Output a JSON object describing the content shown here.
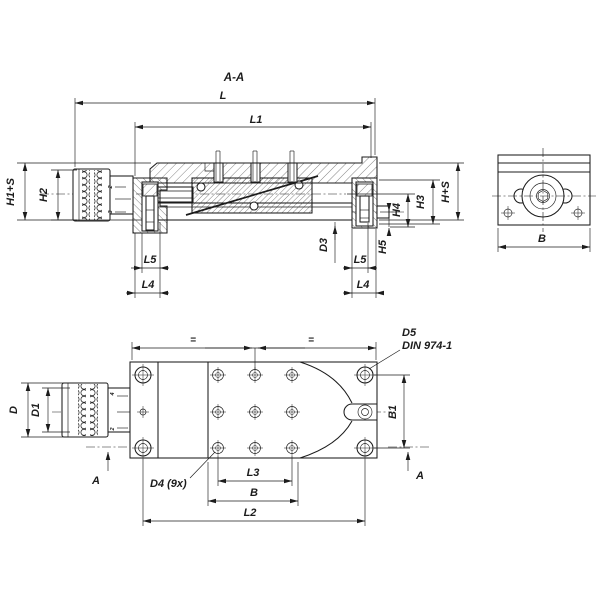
{
  "colors": {
    "ink": "#1c1c1c",
    "background": "#ffffff"
  },
  "title": {
    "section": "A-A"
  },
  "section": {
    "dims": {
      "L": "L",
      "L1": "L1",
      "H1S": "H1+S",
      "H2": "H2",
      "L5_left": "L5",
      "L4_left": "L4",
      "D3": "D3",
      "L5_right": "L5",
      "L4_right": "L4",
      "H5": "H5",
      "H4": "H4",
      "H3": "H3",
      "HS": "H+S"
    },
    "dial": {
      "top": "2",
      "bottom": "3"
    }
  },
  "side": {
    "dims": {
      "B": "B"
    }
  },
  "plan": {
    "dims": {
      "eq_left": "=",
      "eq_right": "=",
      "B1": "B1",
      "D": "D",
      "D1": "D1",
      "L3": "L3",
      "B": "B",
      "L2": "L2"
    },
    "callouts": {
      "D5": "D5",
      "DIN": "DIN 974-1",
      "D4": "D4 (9x)"
    },
    "section_arrows": {
      "left": "A",
      "right": "A"
    },
    "dial": {
      "top": "4",
      "bottom": "2"
    }
  }
}
